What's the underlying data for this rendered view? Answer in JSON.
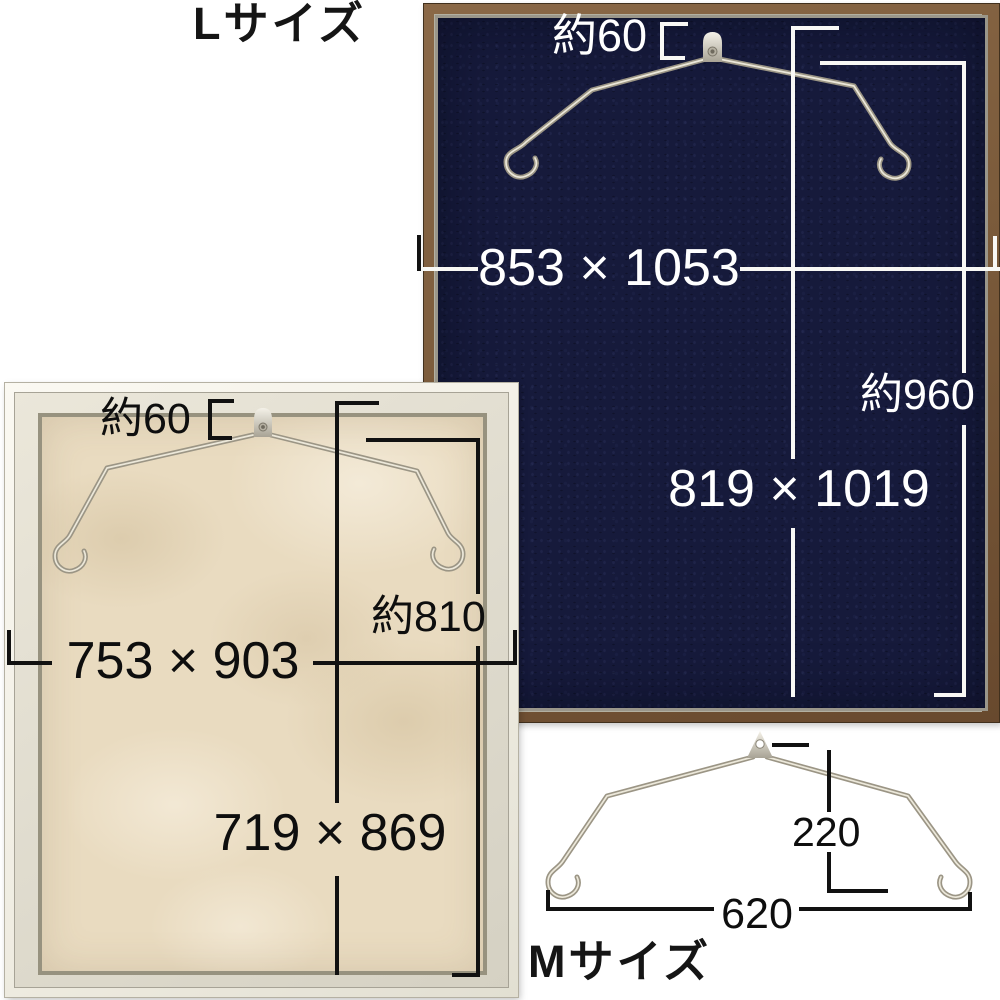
{
  "l_frame": {
    "label": "Lサイズ",
    "hook_offset": "約60",
    "outer_dimensions": "853 × 1053",
    "hanging_height": "約960",
    "inner_dimensions": "819 × 1019",
    "frame_color": "#7b5b3b",
    "panel_color": "#161a3b",
    "annotation_color": "#ffffff"
  },
  "m_frame": {
    "hook_offset": "約60",
    "outer_dimensions": "753 × 903",
    "hanging_height": "約810",
    "inner_dimensions": "719 × 869",
    "frame_color": "#f4f2e9",
    "panel_color": "#e9dbc0",
    "annotation_color": "#111111"
  },
  "hanger": {
    "label": "Mサイズ",
    "drop_height": "220",
    "width": "620",
    "wire_color": "#9b9585"
  }
}
